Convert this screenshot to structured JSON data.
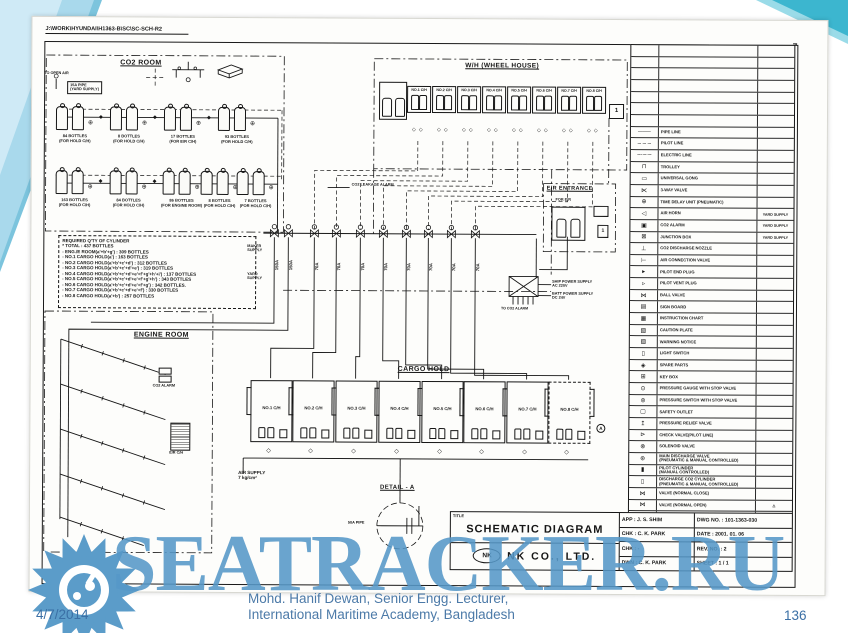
{
  "slide": {
    "date": "4/7/2014",
    "page": "136",
    "caption_line1": "Mohd. Hanif Dewan, Senior Engg. Lecturer,",
    "caption_line2": "International Maritime Academy, Bangladesh",
    "watermark": "SEATRACKER.RU",
    "accent_color": "#5597c7"
  },
  "drawing": {
    "file_path": "J:\\WORK\\HYUNDAI\\H1363-B\\SC\\SC-SCH-R2",
    "sheet_mark": "7",
    "co2_room": {
      "title": "CO2 ROOM",
      "vent_label": "TO OPEN AIR",
      "pipe_box": "15A PIPE\n(YARD SUPPLY)",
      "row1": [
        {
          "qty": "84 BOTTLES",
          "for": "(FOR HOLD C/H)"
        },
        {
          "qty": "8 BOTTLES",
          "for": "(FOR HOLD C/H)"
        },
        {
          "qty": "17 BOTTLES",
          "for": "(FOR E/R C/H)"
        },
        {
          "qty": "93 BOTTLES",
          "for": "(FOR HOLD C/H)"
        }
      ],
      "row2": [
        {
          "qty": "163 BOTTLES",
          "for": "(FOR HOLD C/H)"
        },
        {
          "qty": "84 BOTTLES",
          "for": "(FOR HOLD C/H)"
        },
        {
          "qty": "86 BOTTLES",
          "for": "(FOR ENGINE ROOM)"
        },
        {
          "qty": "8 BOTTLES",
          "for": "(FOR HOLD C/H)"
        },
        {
          "qty": "7 BOTTLES",
          "for": "(FOR HOLD C/H)"
        }
      ]
    },
    "required_qty": {
      "lines": [
        "REQUIRED Q'TY OF CYLINDER",
        "* TOTAL : 437 BOTTLES",
        "- ENG./E ROOM(a'+b'+g') : 309 BOTTLES",
        "- NO.1 CARGO HOLD(a') : 163 BOTTLES",
        "- NO.2 CARGO HOLD(a'+b'+c'+d') : 312 BOTTLES",
        "- NO.3 CARGO HOLD(a'+b'+c'+d'+e') : 319 BOTTLES",
        "- NO.4 CARGO HOLD(a'+b'+c'+d'+e'+f'+g'+h'+i') : 137 BOTTLES",
        "- NO.5 CARGO HOLD(a'+b'+c'+d'+e'+f'+g'+h') : 343 BOTTLES",
        "- NO.6 CARGO HOLD(a'+b'+c'+d'+e'+f'+g') : 342 BOTTLES.",
        "- NO.7 CARGO HOLD(a'+b'+c'+d'+e'+f') : 330 BOTTLES",
        "- NO.8 CARGO HOLD(a'+b') : 257 BOTTLES"
      ]
    },
    "wheel_house": {
      "title": "W/H (WHEEL HOUSE)",
      "cabinets": [
        "NO.1 C/H",
        "NO.2 C/H",
        "NO.3 C/H",
        "NO.4 C/H",
        "NO.5 C/H",
        "NO.6 C/H",
        "NO.7 C/H",
        "NO.8 C/H"
      ],
      "box_mark": "1"
    },
    "er_entrance": {
      "title": "E/R ENTRANCE",
      "cabinet": "FOR E/R",
      "box_mark": "1"
    },
    "engine_room": {
      "title": "ENGINE ROOM",
      "alarm_label": "CO2 ALARM",
      "box_label": "E/R C/H"
    },
    "cargo_hold": {
      "title": "CARGO HOLD",
      "holds": [
        "NO.1 C/H",
        "NO.2 C/H",
        "NO.3 C/H",
        "NO.4 C/H",
        "NO.5 C/H",
        "NO.6 C/H",
        "NO.7 C/H",
        "NO.8 C/H"
      ],
      "air_supply": "AIR SUPPLY\n7 kg/cm²",
      "detail_mark": "A"
    },
    "manifold": {
      "maker_supply": "MAKER\nSUPPLY",
      "yard_supply": "YARD\nSUPPLY",
      "pipe_sizes": [
        "150A",
        "150A",
        "70A",
        "70A",
        "70A",
        "70A",
        "70A",
        "70A",
        "70A",
        "70A"
      ],
      "leak_alarm": "CO2 LEAKAGE ALARM",
      "ship_power": "SHIP POWER SUPPLY\nAC 220V",
      "batt_power": "BATT POWER SUPPLY\nDC 24V",
      "to_alarm": "TO CO2 ALARM"
    },
    "detail_a": {
      "title": "DETAIL - A",
      "pipe_label": "50A PIPE"
    },
    "legend": {
      "empty_rows": 7,
      "rows": [
        {
          "g": "───",
          "d": "PIPE LINE",
          "r": ""
        },
        {
          "g": "– – –",
          "d": "PILOT LINE",
          "r": ""
        },
        {
          "g": "–·–·–",
          "d": "ELECTRIC LINE",
          "r": ""
        },
        {
          "g": "⊓",
          "d": "TROLLEY",
          "r": ""
        },
        {
          "g": "▭",
          "d": "UNIVERSAL GONG",
          "r": ""
        },
        {
          "g": "⋉",
          "d": "3-WAY VALVE",
          "r": ""
        },
        {
          "g": "⊕",
          "d": "TIME DELAY UNIT (PNEUMATIC)",
          "r": ""
        },
        {
          "g": "◁",
          "d": "AIR HORN",
          "r": "YARD SUPPLY"
        },
        {
          "g": "▣",
          "d": "CO2 ALARM",
          "r": "YARD SUPPLY"
        },
        {
          "g": "⊠",
          "d": "JUNCTION BOX",
          "r": "YARD SUPPLY"
        },
        {
          "g": "⊥",
          "d": "CO2 DISCHARGE NOZZLE",
          "r": ""
        },
        {
          "g": "⊢",
          "d": "AIR CONNECTION VALVE",
          "r": ""
        },
        {
          "g": "▸",
          "d": "PILOT END PLUG",
          "r": ""
        },
        {
          "g": "▹",
          "d": "PILOT VENT PLUG",
          "r": ""
        },
        {
          "g": "⋈",
          "d": "BALL VALVE",
          "r": ""
        },
        {
          "g": "▤",
          "d": "SIGN BOARD",
          "r": ""
        },
        {
          "g": "▦",
          "d": "INSTRUCTION CHART",
          "r": ""
        },
        {
          "g": "▧",
          "d": "CAUTION PLATE",
          "r": ""
        },
        {
          "g": "▨",
          "d": "WARNING NOTICE",
          "r": ""
        },
        {
          "g": "▯",
          "d": "LIGHT SWITCH",
          "r": ""
        },
        {
          "g": "◈",
          "d": "SPARE PARTS",
          "r": ""
        },
        {
          "g": "⊞",
          "d": "KEY BOX",
          "r": ""
        },
        {
          "g": "⊙",
          "d": "PRESSURE GAUGE WITH STOP VALVE",
          "r": ""
        },
        {
          "g": "⊚",
          "d": "PRESSURE SWITCH WITH STOP VALVE",
          "r": ""
        },
        {
          "g": "▢",
          "d": "SAFETY OUTLET",
          "r": ""
        },
        {
          "g": "↥",
          "d": "PRESSURE RELIEF VALVE",
          "r": ""
        },
        {
          "g": "⊳",
          "d": "CHECK VALVE(PILOT LINE)",
          "r": ""
        },
        {
          "g": "⊗",
          "d": "SOLENOID VALVE",
          "r": ""
        },
        {
          "g": "⊛",
          "d": "MAIN DISCHARGE VALVE\n(PNEUMATIC & MANUAL CONTROLLED)",
          "r": ""
        },
        {
          "g": "▮",
          "d": "PILOT CYLINDER\n(MANUAL CONTROLLED)",
          "r": ""
        },
        {
          "g": "▯",
          "d": "DISCHARGE CO2 CYLINDER\n(PNEUMATIC & MANUAL CONTROLLED)",
          "r": ""
        },
        {
          "g": "⋈",
          "d": "VALVE (NORMAL CLOSE)",
          "r": ""
        },
        {
          "g": "⋈",
          "d": "VALVE (NORMAL OPEN)",
          "r": "△"
        }
      ],
      "footer": {
        "symbol": "SYMBOL",
        "desc": "DESCRIPTION",
        "remark": "REMARK"
      }
    },
    "title_block": {
      "title_label": "TITLE",
      "title": "SCHEMATIC DIAGRAM",
      "logo": "NK",
      "company": "NK CO., LTD.",
      "rows": [
        {
          "left": "APP : J. S. SHIM",
          "right": "DWG NO. : 101-1363-030"
        },
        {
          "left": "CHK : C. K. PARK",
          "right": "DATE : 2001. 01. 06"
        },
        {
          "left": "CHK : -",
          "right": "REV. NO. : 2"
        },
        {
          "left": "DWN : C. K. PARK",
          "right": "SHEET : 1 / 1"
        }
      ]
    }
  }
}
